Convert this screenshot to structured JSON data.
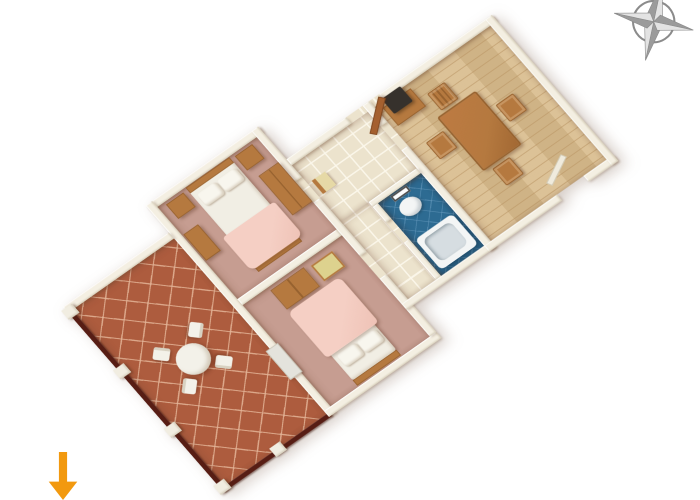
{
  "scene": {
    "title": "apartment-3d-floor-plan",
    "background": "#ffffff"
  },
  "colors": {
    "wall": "#f4efe2",
    "wall_edge": "#d8d0bc",
    "terracotta": "#ad5c3e",
    "terracotta_line": "rgba(228,181,152,0.85)",
    "rose_floor": "#c69d91",
    "cream_tile": "#ece3cd",
    "cream_tile_line": "rgba(252,248,236,0.9)",
    "wood_floor": "#d9bd8f",
    "wood_floor_line": "rgba(185,148,99,0.55)",
    "blue_floor": "#2d6b92",
    "blue_floor_line": "rgba(110,160,195,0.55)",
    "furniture_wood": "#b5793f",
    "furniture_wood_dark": "#97622f",
    "bed_sheet": "#f1eee4",
    "bed_blanket": "#f5cfc4",
    "pillow": "#f8f6ee",
    "bath_white": "#f3f5f5",
    "tub_inner": "#d6dde1",
    "railing": "#571d14",
    "post": "#f1ede1",
    "table_white": "#f3f1e9",
    "desk_top": "#ddd28e",
    "desk_seat": "#e6d9a6",
    "tv": "#36312c",
    "door_wood": "#a5602f",
    "compass_dark": "#9b9b9b",
    "compass_light": "#e3e3e3",
    "compass_stroke": "#8b8b8b",
    "arrow": "#f2990f",
    "shadow": "rgba(110,75,50,0.3)"
  },
  "rooms": [
    {
      "id": "terrace",
      "floor": "terracotta-tiles",
      "items": [
        "round-table",
        "chair",
        "chair",
        "chair",
        "chair",
        "railing",
        "posts"
      ]
    },
    {
      "id": "bedroom-1",
      "floor": "rose-carpet",
      "items": [
        "double-bed",
        "two-pillows",
        "pink-blanket",
        "nightstand",
        "nightstand",
        "wardrobe",
        "dresser"
      ]
    },
    {
      "id": "bedroom-2",
      "floor": "rose-carpet",
      "items": [
        "double-bed",
        "two-pillows",
        "pink-blanket",
        "wardrobe",
        "desk",
        "terrace-door"
      ]
    },
    {
      "id": "entry-hall",
      "floor": "cream-tiles",
      "items": [
        "entry-door-open",
        "chair"
      ]
    },
    {
      "id": "corridor",
      "floor": "cream-tiles",
      "items": []
    },
    {
      "id": "bathroom",
      "floor": "blue-tiles",
      "items": [
        "mirror",
        "sink",
        "bathtub"
      ]
    },
    {
      "id": "dining-room",
      "floor": "wood-parquet",
      "items": [
        "tv-cabinet",
        "tv",
        "dining-table",
        "chair",
        "chair",
        "chair",
        "chair",
        "balcony-door"
      ]
    }
  ],
  "overlays": {
    "compass": {
      "name": "compass-rose",
      "points": 4,
      "tilt_deg": 12,
      "position": "top-right"
    },
    "arrow": {
      "name": "direction-arrow",
      "direction": "down",
      "position": "bottom-left"
    }
  }
}
